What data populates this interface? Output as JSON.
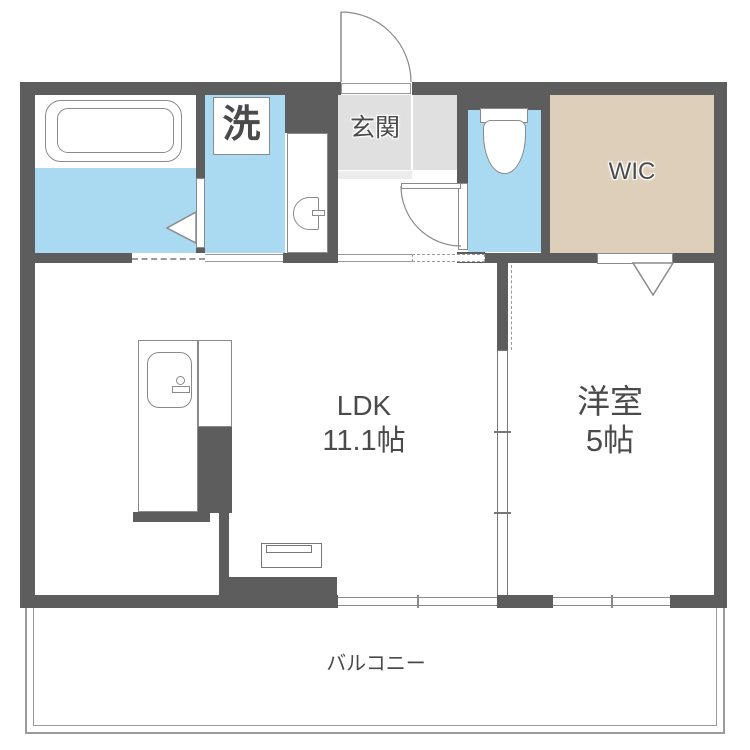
{
  "rooms": {
    "ldk": {
      "name": "LDK",
      "size": "11.1帖"
    },
    "western": {
      "name": "洋室",
      "size": "5帖"
    },
    "wic": {
      "name": "WIC"
    },
    "entrance": {
      "name": "玄関"
    },
    "laundry": {
      "name": "洗"
    },
    "balcony": {
      "name": "バルコニー"
    }
  },
  "colors": {
    "wall": "#5d5d5d",
    "water": "#aad9f2",
    "entrance_floor": "#e0e0e0",
    "entrance_step": "#ececec",
    "wic_floor": "#ddcfb9",
    "text": "#4a4a4a",
    "line": "#8a8a8a"
  }
}
